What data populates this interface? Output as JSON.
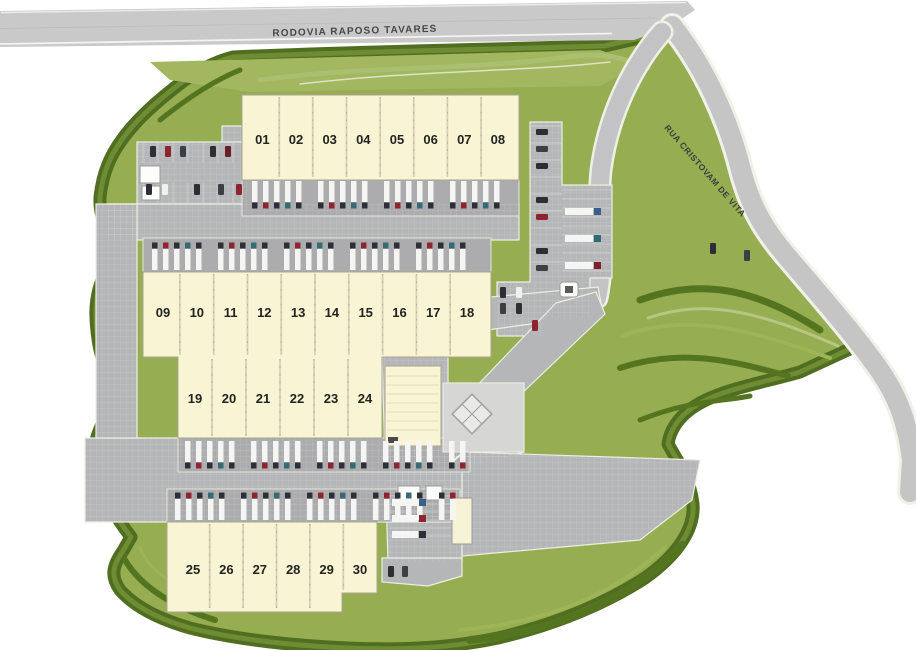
{
  "plan": {
    "type": "industrial-park-master-plan",
    "roads": {
      "highway": "RODOVIA RAPOSO TAVARES",
      "street": "RUA CRISTOVAM DE VITA"
    },
    "buildings": [
      {
        "name": "warehouse-row-a",
        "units": [
          "01",
          "02",
          "03",
          "04",
          "05",
          "06",
          "07",
          "08"
        ]
      },
      {
        "name": "warehouse-row-b",
        "units": [
          "09",
          "10",
          "11",
          "12",
          "13",
          "14",
          "15",
          "16",
          "17",
          "18"
        ]
      },
      {
        "name": "warehouse-row-c",
        "units": [
          "19",
          "20",
          "21",
          "22",
          "23",
          "24"
        ]
      },
      {
        "name": "warehouse-row-d",
        "units": [
          "25",
          "26",
          "27",
          "28",
          "29",
          "30"
        ]
      }
    ],
    "colors": {
      "site_green": "#96ad52",
      "border_green": "#4f6e20",
      "accent_green": "#a3b863",
      "road_gray": "#c9c9c9",
      "pavement_gray": "#b5b6b8",
      "building_cream": "#f8f4d4",
      "label_dark": "#232320"
    }
  }
}
